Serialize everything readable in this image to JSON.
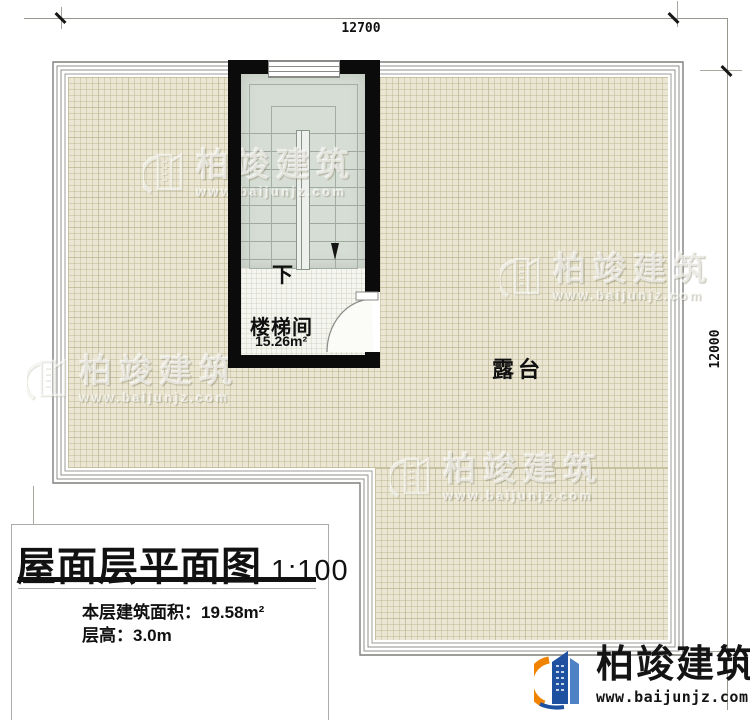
{
  "dimensions": {
    "top": "12700",
    "right": "12000"
  },
  "stairwell": {
    "name": "楼梯间",
    "area": "15.26m²",
    "direction": "下"
  },
  "terrace": {
    "name": "露台"
  },
  "title_block": {
    "title": "屋面层平面图",
    "scale": "1:100",
    "floor_area_label": "本层建筑面积：",
    "floor_area_value": "19.58m²",
    "floor_height_label": "层高：",
    "floor_height_value": "3.0m"
  },
  "watermark": {
    "name": "柏竣建筑",
    "url": "www.baijunjz.com"
  },
  "logo": {
    "name": "柏竣建筑",
    "url": "www.baijunjz.com"
  },
  "colors": {
    "floor_beige": "#EAE6D3",
    "grid_line": "#D5CFB4",
    "stair_fill": "#D6DDD4",
    "wall_black": "#0B0B0B",
    "logo_blue": "#1E52A0",
    "logo_orange": "#F08300"
  }
}
